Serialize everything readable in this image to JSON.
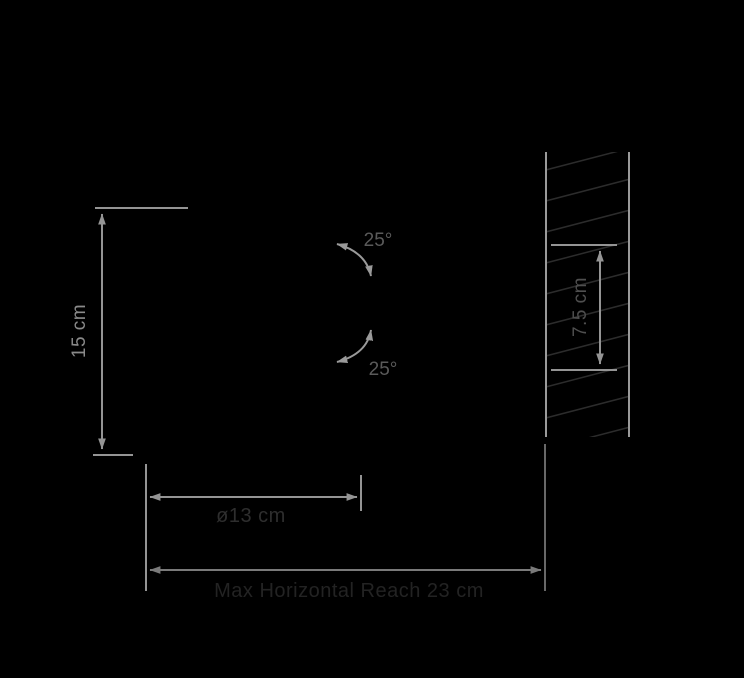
{
  "canvas": {
    "width": 744,
    "height": 678,
    "background": "#000000"
  },
  "labels": {
    "height": "15 cm",
    "tilt_up": "25°",
    "tilt_down": "25°",
    "wall_bracket_height": "7.5 cm",
    "shade_diameter": "ø13 cm",
    "max_reach": "Max Horizontal Reach 23 cm"
  },
  "values": {
    "height_cm": 15,
    "tilt_up_deg": 25,
    "tilt_down_deg": 25,
    "wall_bracket_height_cm": 7.5,
    "shade_diameter_cm": 13,
    "max_horizontal_reach_cm": 23
  },
  "colors": {
    "background": "#000000",
    "dimension_line": "#949494",
    "arc_line": "#9a9a9a",
    "wall_edge": "#9a9a9a",
    "hatch_line": "#2c2c2c",
    "reach_line": "#7a7a7a",
    "label_height": "#8a8a8a",
    "label_angle": "#5a5a5a",
    "label_bracket": "#4f4f4f",
    "label_diameter": "#2e2e2e",
    "label_reach": "#232323"
  }
}
